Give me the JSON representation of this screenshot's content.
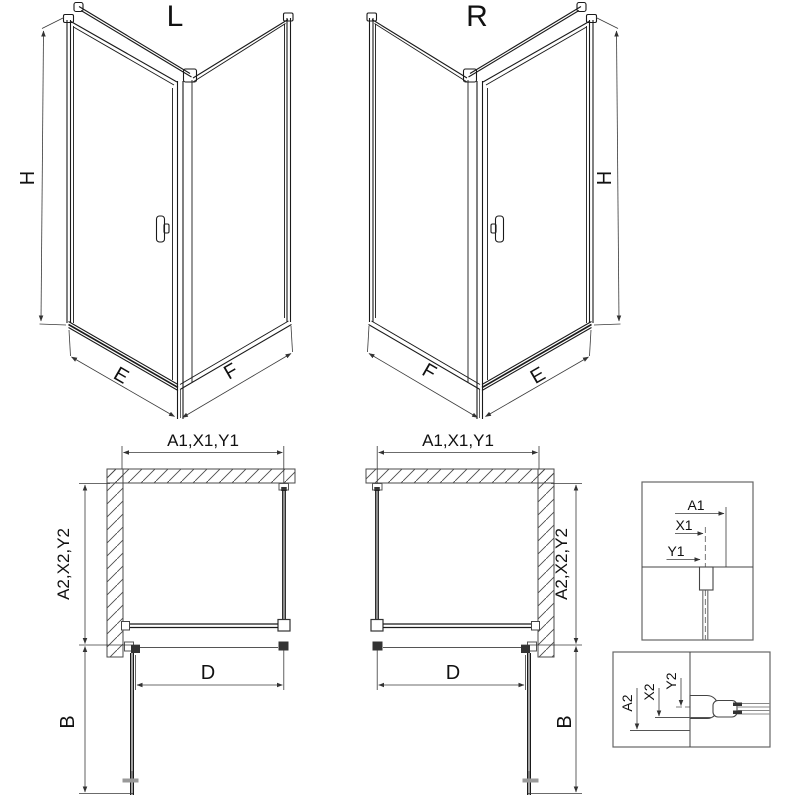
{
  "colors": {
    "background": "#ffffff",
    "drawing_line": "#1a1a1a",
    "dimension_line": "#3a3a3a",
    "wall_hatch": "#4a4a4a"
  },
  "iso_left": {
    "label": "L",
    "dim_height": "H",
    "dim_front_width": "E",
    "dim_side_width": "F"
  },
  "iso_right": {
    "label": "R",
    "dim_height": "H",
    "dim_front_width": "E",
    "dim_side_width": "F"
  },
  "plan_left": {
    "dim_top": "A1,X1,Y1",
    "dim_side": "A2,X2,Y2",
    "dim_door_opening": "D",
    "dim_door_swing": "B"
  },
  "plan_right": {
    "dim_top": "A1,X1,Y1",
    "dim_side": "A2,X2,Y2",
    "dim_door_opening": "D",
    "dim_door_swing": "B"
  },
  "detail_wall_profile": {
    "dim_a": "A1",
    "dim_x": "X1",
    "dim_y": "Y1"
  },
  "detail_bottom_profile": {
    "dim_a": "A2",
    "dim_x": "X2",
    "dim_y": "Y2"
  }
}
